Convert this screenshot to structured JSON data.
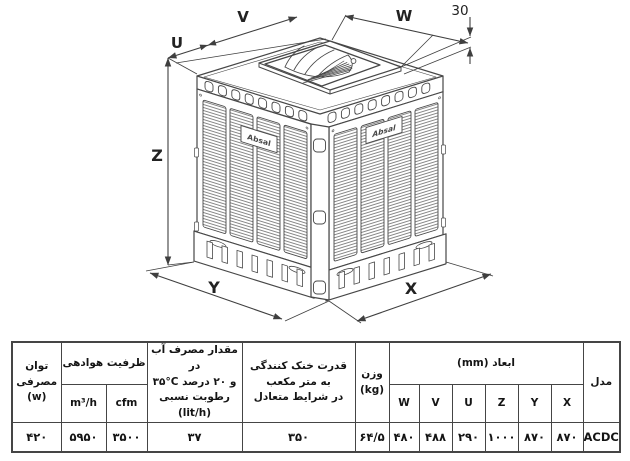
{
  "diagram": {
    "brand": "Absal",
    "labels": {
      "u": "U",
      "v": "V",
      "w": "W",
      "x": "X",
      "y": "Y",
      "z": "Z",
      "platform_height": "30"
    }
  },
  "table": {
    "model": {
      "header": "مدل",
      "value": "ACDC68"
    },
    "dimensions": {
      "header": "ابعاد (mm)",
      "cols": [
        {
          "label": "X",
          "value": "۸۷۰"
        },
        {
          "label": "Y",
          "value": "۸۷۰"
        },
        {
          "label": "Z",
          "value": "۱۰۰۰"
        },
        {
          "label": "U",
          "value": "۲۹۰"
        },
        {
          "label": "V",
          "value": "۴۸۸"
        },
        {
          "label": "W",
          "value": "۴۸۰"
        }
      ]
    },
    "weight": {
      "line1": "وزن",
      "line2": "(kg)",
      "value": "۶۴/۵"
    },
    "cooling": {
      "line1": "قدرت خنک کنندگی",
      "line2": "به متر مکعب",
      "line3": "در شرایط متعادل",
      "value": "۳۵۰"
    },
    "water": {
      "line1": "مقدار مصرف آب در",
      "line2_parts": {
        "a": "۳۵°C",
        "b": "و",
        "c": "۲۰",
        "d": "درصد"
      },
      "line3": "رطوبت نسبی",
      "line4": "(lit/h)",
      "value": "۳۷"
    },
    "airflow": {
      "header": "ظرفیت هوادهی",
      "m3h_label": "m³/h",
      "cfm_label": "cfm",
      "m3h_value": "۵۹۵۰",
      "cfm_value": "۳۵۰۰"
    },
    "power": {
      "line1": "توان",
      "line2": "مصرفی",
      "line3": "(w)",
      "value": "۴۲۰"
    }
  }
}
